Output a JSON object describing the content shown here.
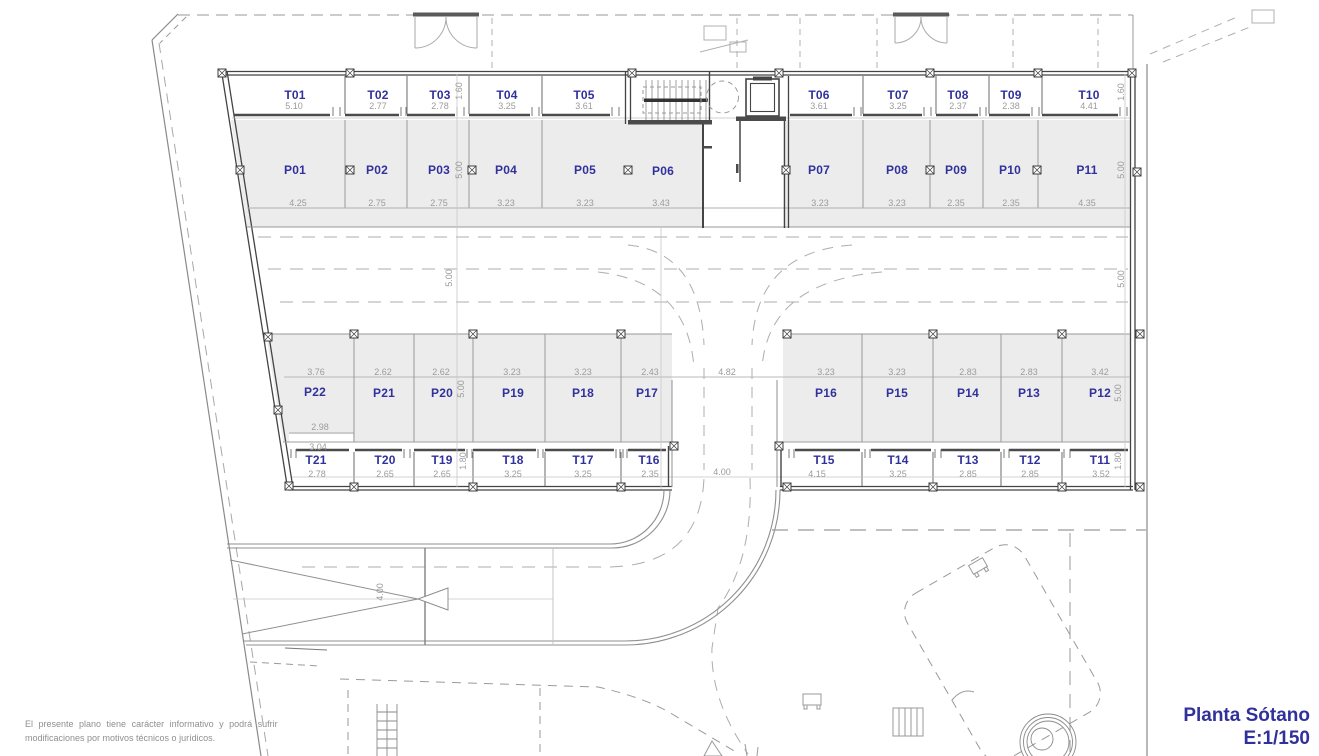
{
  "plan": {
    "title": "Planta Sótano",
    "scale": "E:1/150",
    "disclaimer": [
      "El presente plano tiene carácter informativo y podrá sufrir",
      "modificaciones por motivos técnicos o jurídicos."
    ],
    "colors": {
      "label_blue": "#31319c",
      "dimension_gray": "#9b9b9b",
      "stall_fill": "#ececec",
      "line_gray": "#8f8f8f",
      "wall_dark": "#454545"
    },
    "parking_spaces": [
      {
        "id": "P01",
        "width": "4.25",
        "x": 295,
        "y": 170,
        "dx": 298,
        "dy": 203
      },
      {
        "id": "P02",
        "width": "2.75",
        "x": 377,
        "y": 170,
        "dx": 377,
        "dy": 203
      },
      {
        "id": "P03",
        "width": "2.75",
        "x": 439,
        "y": 170,
        "dx": 439,
        "dy": 203
      },
      {
        "id": "P04",
        "width": "3.23",
        "x": 506,
        "y": 170,
        "dx": 506,
        "dy": 203
      },
      {
        "id": "P05",
        "width": "3.23",
        "x": 585,
        "y": 170,
        "dx": 585,
        "dy": 203
      },
      {
        "id": "P06",
        "width": "3.43",
        "x": 663,
        "y": 171,
        "dx": 661,
        "dy": 203
      },
      {
        "id": "P07",
        "width": "3.23",
        "x": 819,
        "y": 170,
        "dx": 820,
        "dy": 203
      },
      {
        "id": "P08",
        "width": "3.23",
        "x": 897,
        "y": 170,
        "dx": 897,
        "dy": 203
      },
      {
        "id": "P09",
        "width": "2.35",
        "x": 956,
        "y": 170,
        "dx": 956,
        "dy": 203
      },
      {
        "id": "P10",
        "width": "2.35",
        "x": 1010,
        "y": 170,
        "dx": 1011,
        "dy": 203
      },
      {
        "id": "P11",
        "width": "4.35",
        "x": 1087,
        "y": 170,
        "dx": 1087,
        "dy": 203
      },
      {
        "id": "P12",
        "width": "3.42",
        "x": 1100,
        "y": 393,
        "dx": 1100,
        "dy": 372
      },
      {
        "id": "P13",
        "width": "2.83",
        "x": 1029,
        "y": 393,
        "dx": 1029,
        "dy": 372
      },
      {
        "id": "P14",
        "width": "2.83",
        "x": 968,
        "y": 393,
        "dx": 968,
        "dy": 372
      },
      {
        "id": "P15",
        "width": "3.23",
        "x": 897,
        "y": 393,
        "dx": 897,
        "dy": 372
      },
      {
        "id": "P16",
        "width": "3.23",
        "x": 826,
        "y": 393,
        "dx": 826,
        "dy": 372
      },
      {
        "id": "P17",
        "width": "2.43",
        "x": 647,
        "y": 393,
        "dx": 650,
        "dy": 372
      },
      {
        "id": "P18",
        "width": "3.23",
        "x": 583,
        "y": 393,
        "dx": 583,
        "dy": 372
      },
      {
        "id": "P19",
        "width": "3.23",
        "x": 513,
        "y": 393,
        "dx": 512,
        "dy": 372
      },
      {
        "id": "P20",
        "width": "2.62",
        "x": 442,
        "y": 393,
        "dx": 441,
        "dy": 372
      },
      {
        "id": "P21",
        "width": "2.62",
        "x": 384,
        "y": 393,
        "dx": 383,
        "dy": 372
      },
      {
        "id": "P22",
        "width": "3.76",
        "x": 315,
        "y": 392,
        "dx": 316,
        "dy": 372
      }
    ],
    "storage_rooms": [
      {
        "id": "T01",
        "width": "5.10",
        "x": 295,
        "y": 95,
        "dx": 294,
        "dy": 106
      },
      {
        "id": "T02",
        "width": "2.77",
        "x": 378,
        "y": 95,
        "dx": 378,
        "dy": 106
      },
      {
        "id": "T03",
        "width": "2.78",
        "x": 440,
        "y": 95,
        "dx": 440,
        "dy": 106
      },
      {
        "id": "T04",
        "width": "3.25",
        "x": 507,
        "y": 95,
        "dx": 507,
        "dy": 106
      },
      {
        "id": "T05",
        "width": "3.61",
        "x": 584,
        "y": 95,
        "dx": 584,
        "dy": 106
      },
      {
        "id": "T06",
        "width": "3.61",
        "x": 819,
        "y": 95,
        "dx": 819,
        "dy": 106
      },
      {
        "id": "T07",
        "width": "3.25",
        "x": 898,
        "y": 95,
        "dx": 898,
        "dy": 106
      },
      {
        "id": "T08",
        "width": "2.37",
        "x": 958,
        "y": 95,
        "dx": 958,
        "dy": 106
      },
      {
        "id": "T09",
        "width": "2.38",
        "x": 1011,
        "y": 95,
        "dx": 1011,
        "dy": 106
      },
      {
        "id": "T10",
        "width": "4.41",
        "x": 1089,
        "y": 95,
        "dx": 1089,
        "dy": 106
      },
      {
        "id": "T11",
        "width": "3.52",
        "x": 1100,
        "y": 460,
        "dx": 1101,
        "dy": 474
      },
      {
        "id": "T12",
        "width": "2.85",
        "x": 1030,
        "y": 460,
        "dx": 1030,
        "dy": 474
      },
      {
        "id": "T13",
        "width": "2.85",
        "x": 968,
        "y": 460,
        "dx": 968,
        "dy": 474
      },
      {
        "id": "T14",
        "width": "3.25",
        "x": 898,
        "y": 460,
        "dx": 898,
        "dy": 474
      },
      {
        "id": "T15",
        "width": "4.15",
        "x": 824,
        "y": 460,
        "dx": 817,
        "dy": 474
      },
      {
        "id": "T16",
        "width": "2.35",
        "x": 649,
        "y": 460,
        "dx": 650,
        "dy": 474
      },
      {
        "id": "T17",
        "width": "3.25",
        "x": 583,
        "y": 460,
        "dx": 583,
        "dy": 474
      },
      {
        "id": "T18",
        "width": "3.25",
        "x": 513,
        "y": 460,
        "dx": 513,
        "dy": 474
      },
      {
        "id": "T19",
        "width": "2.65",
        "x": 442,
        "y": 460,
        "dx": 442,
        "dy": 474
      },
      {
        "id": "T20",
        "width": "2.65",
        "x": 385,
        "y": 460,
        "dx": 385,
        "dy": 474
      },
      {
        "id": "T21",
        "width": "2.78",
        "x": 316,
        "y": 460,
        "dx": 317,
        "dy": 474
      }
    ],
    "dimensions": [
      {
        "text": "1.60",
        "x": 459,
        "y": 91,
        "rotated": true
      },
      {
        "text": "1.60",
        "x": 1121,
        "y": 92,
        "rotated": true
      },
      {
        "text": "5.00",
        "x": 459,
        "y": 170,
        "rotated": true
      },
      {
        "text": "5.00",
        "x": 1121,
        "y": 170,
        "rotated": true
      },
      {
        "text": "5.00",
        "x": 449,
        "y": 278,
        "rotated": true
      },
      {
        "text": "5.00",
        "x": 1121,
        "y": 279,
        "rotated": true
      },
      {
        "text": "5.00",
        "x": 461,
        "y": 389,
        "rotated": true
      },
      {
        "text": "5.00",
        "x": 1118,
        "y": 393,
        "rotated": true
      },
      {
        "text": "1.80",
        "x": 463,
        "y": 461,
        "rotated": true
      },
      {
        "text": "1.80",
        "x": 1118,
        "y": 461,
        "rotated": true
      },
      {
        "text": "4.82",
        "x": 727,
        "y": 372,
        "rotated": false
      },
      {
        "text": "4.00",
        "x": 722,
        "y": 472,
        "rotated": false
      },
      {
        "text": "4.00",
        "x": 380,
        "y": 592,
        "rotated": true
      },
      {
        "text": "2.98",
        "x": 320,
        "y": 427,
        "rotated": false
      },
      {
        "text": "3.04",
        "x": 318,
        "y": 447,
        "rotated": false
      }
    ]
  }
}
